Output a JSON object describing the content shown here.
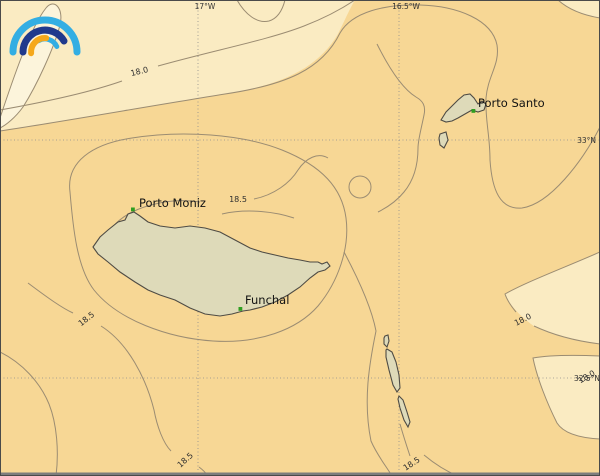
{
  "colors": {
    "ocean_main": "#F7D795",
    "ocean_light": "#FAEBC2",
    "ocean_lightest": "#FCF4DB",
    "contour": "#9B8C72",
    "island_fill": "#DEDAB9",
    "island_stroke": "#4E4B44",
    "grid": "#8D8D8D",
    "marker_green": "#2F9E20",
    "logo_cyan": "#33AEE3",
    "logo_navy": "#20398C",
    "logo_orange": "#F5A81C",
    "frame": "#4A4A4A",
    "bottom_bar": "#7D7D7D"
  },
  "logo": {
    "name": "rainbow-arcs-logo"
  },
  "grid": {
    "lon": [
      {
        "label": "17°W"
      },
      {
        "label": "16.5°W"
      }
    ],
    "lat": [
      {
        "label": "33°N"
      },
      {
        "label": "32.5°N"
      }
    ]
  },
  "places": [
    {
      "name": "Porto Moniz"
    },
    {
      "name": "Funchal"
    },
    {
      "name": "Porto Santo"
    }
  ],
  "contour_labels": [
    {
      "value": "18.0"
    },
    {
      "value": "18.5"
    },
    {
      "value": "18.5"
    },
    {
      "value": "18.0"
    },
    {
      "value": "18.5"
    },
    {
      "value": "18.5"
    },
    {
      "value": "18.0"
    }
  ],
  "contours": {
    "levels": [
      "18.0",
      "18.5"
    ]
  }
}
